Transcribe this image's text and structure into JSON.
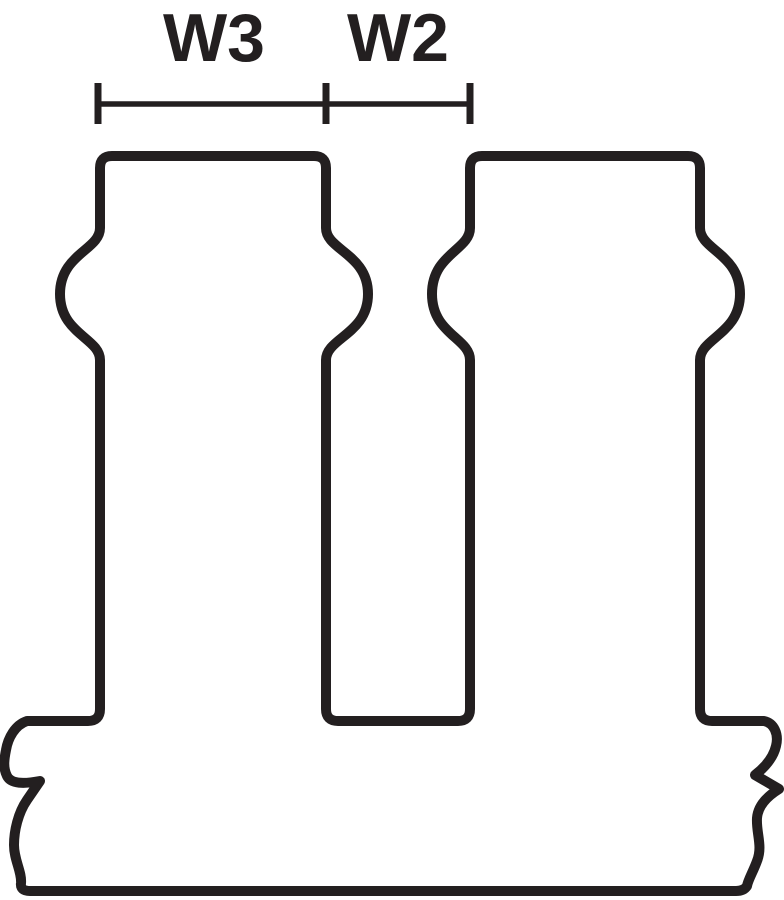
{
  "diagram": {
    "dimension_labels": {
      "w3": "W3",
      "w2": "W2"
    },
    "colors": {
      "line": "#231f20",
      "background": "#ffffff"
    }
  }
}
